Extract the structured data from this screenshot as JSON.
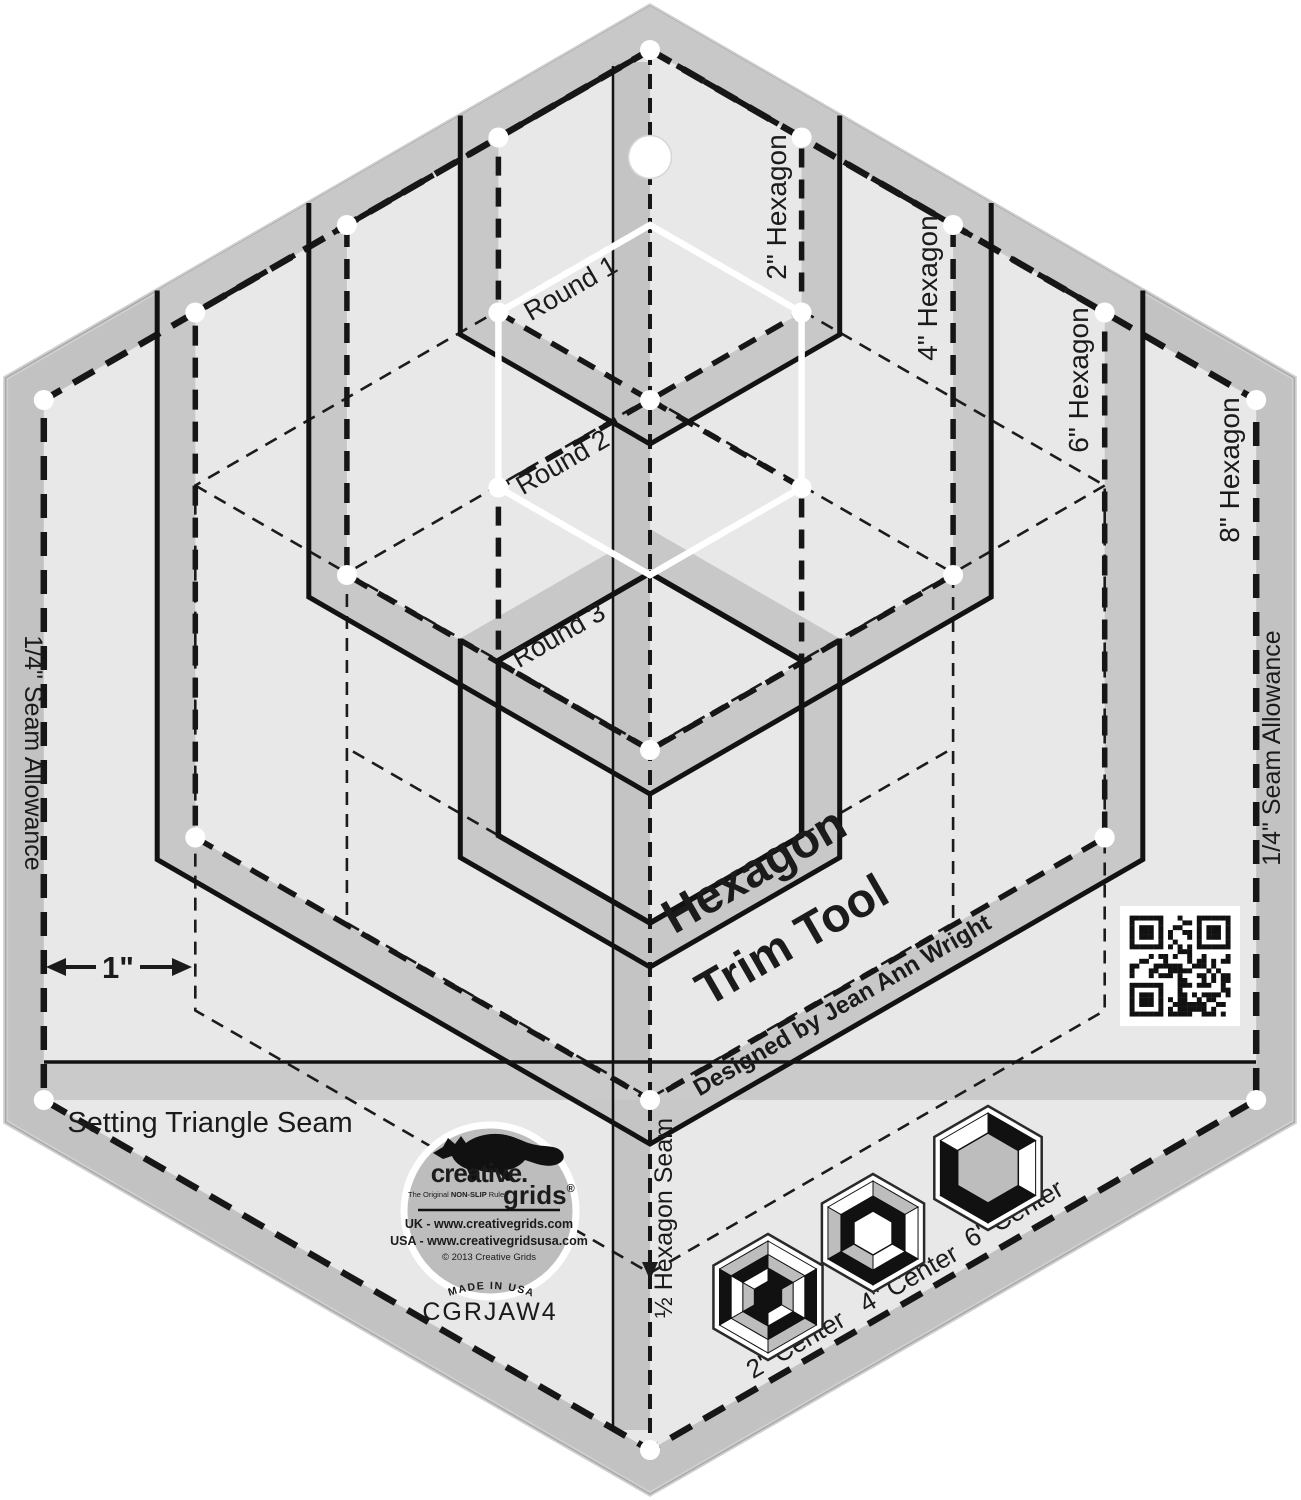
{
  "ruler": {
    "rounds": [
      "Round 1",
      "Round 2",
      "Round 3"
    ],
    "hexagons": [
      "2\" Hexagon",
      "4\" Hexagon",
      "6\" Hexagon",
      "8\" Hexagon"
    ],
    "seam_left": "1/4\" Seam Allowance",
    "seam_right": "1/4\" Seam Allowance",
    "inch": "1\"",
    "setting_triangle": "Setting Triangle Seam",
    "half_hexagon": "½ Hexagon Seam",
    "title1": "Hexagon",
    "title2": "Trim Tool",
    "byline": "Designed by Jean Ann Wright",
    "centers": [
      "2\" Center",
      "4\" Center",
      "6\" Center"
    ]
  },
  "logo": {
    "brand_top": "creative.",
    "brand_bottom": "grids",
    "registered": "®",
    "tagline_pre": "The Original",
    "tagline_bold": "NON-SLIP",
    "tagline_post": "Ruler",
    "url_uk": "UK - www.creativegrids.com",
    "url_usa": "USA - www.creativegridsusa.com",
    "copyright": "© 2013 Creative Grids",
    "made_in": "MADE IN USA",
    "sku": "CGRJAW4"
  },
  "icons": {
    "qr": "qr-code",
    "fox": "fox-logo",
    "hole": "hanging-hole"
  },
  "colors": {
    "body": "#e8e8e8",
    "band": "#c2c2c2",
    "ring_band": "#c8c8c8",
    "line": "#1b1b1b",
    "white_marking": "#ffffff"
  }
}
